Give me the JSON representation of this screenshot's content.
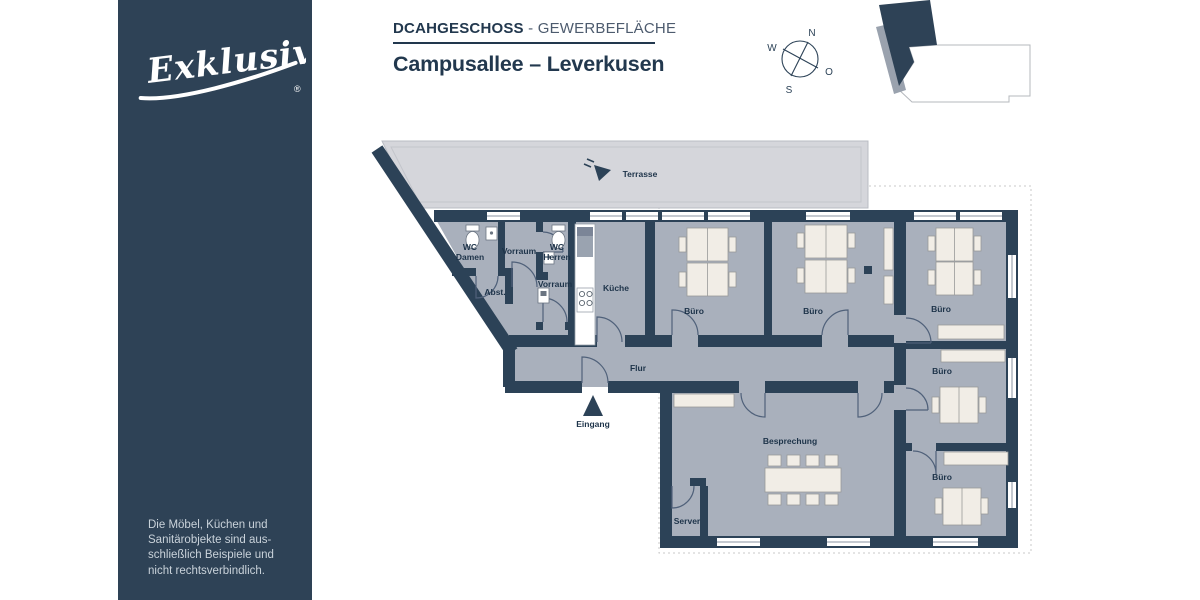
{
  "sidebar": {
    "logo_text": "Exklusiv",
    "registered_mark": "®",
    "disclaimer_lines": {
      "l1": "Die Möbel, Küchen und",
      "l2": "Sanitärobjekte sind aus-",
      "l3": "schließlich Beispiele und",
      "l4": "nicht rechtsverbindlich."
    }
  },
  "header": {
    "subtitle_prefix": "DCAHGESCHOSS",
    "subtitle_separator": "-",
    "subtitle_suffix": "GEWERBEFLÄCHE",
    "title": "Campusallee – Leverkusen"
  },
  "compass": {
    "n": "N",
    "o": "O",
    "s": "S",
    "w": "W"
  },
  "floorplan": {
    "terrace_label": "Terrasse",
    "flur_label": "Flur",
    "eingang_label": "Eingang",
    "kueche_label": "Küche",
    "besprechung_label": "Besprechung",
    "server_label": "Server",
    "abst_label": "Abst.",
    "vorraum_label": "Vorraum",
    "buero_label": "Büro",
    "wc_damen": [
      "WC",
      "Damen"
    ],
    "wc_herren": [
      "WC",
      "Herren"
    ]
  },
  "colors": {
    "brand_navy": "#2e4256",
    "wall_navy": "#2c4257",
    "room_fill": "#a9b0bc",
    "terrace_fill": "#d5d6db",
    "furniture_cream": "#f1ede6"
  }
}
